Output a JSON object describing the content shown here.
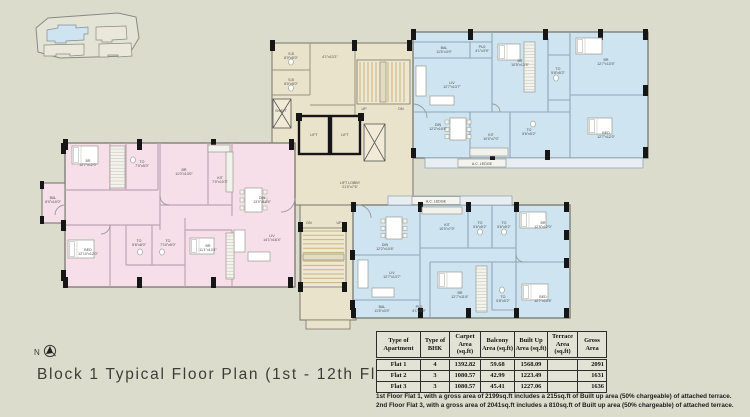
{
  "title": "Block 1 Typical Floor Plan (1st - 12th Floor)",
  "north_label": "N",
  "colors": {
    "background": "#dcdccd",
    "flat1_pink": "#f6dfe9",
    "flat23_blue": "#cee4f0",
    "core_tan": "#eae3cb",
    "stair_tread": "#c9b285",
    "wall_black": "#161616"
  },
  "plan": {
    "ac_ledge_top": "A.C. LEDGE",
    "ac_ledge_bottom": "A.C. LEDGE",
    "labels": [
      {
        "x": 88,
        "y": 162,
        "lines": [
          "BR",
          "12'7\"x12'0\""
        ]
      },
      {
        "x": 142,
        "y": 163,
        "lines": [
          "TO",
          "7'0\"x5'0\""
        ]
      },
      {
        "x": 184,
        "y": 171,
        "lines": [
          "BR",
          "11'0\"x13'0\""
        ]
      },
      {
        "x": 220,
        "y": 179,
        "lines": [
          "KIT",
          "7'0\"x10'3\""
        ]
      },
      {
        "x": 262,
        "y": 199,
        "lines": [
          "DIN",
          "13'0\"x12'4\""
        ]
      },
      {
        "x": 53,
        "y": 199,
        "lines": [
          "BAL",
          "6'0\"x10'0\""
        ]
      },
      {
        "x": 88,
        "y": 251,
        "lines": [
          "BED",
          "12'10\"x12'0\""
        ]
      },
      {
        "x": 139,
        "y": 242,
        "lines": [
          "TO",
          "5'6\"x8'0\""
        ]
      },
      {
        "x": 168,
        "y": 242,
        "lines": [
          "TO",
          "7'10\"x5'0\""
        ]
      },
      {
        "x": 208,
        "y": 247,
        "lines": [
          "BR",
          "11'1\"x10'4\""
        ]
      },
      {
        "x": 272,
        "y": 237,
        "lines": [
          "LIV",
          "14'1\"x16'4\""
        ]
      },
      {
        "x": 291,
        "y": 55,
        "lines": [
          "S.B",
          "8'0\"x5'0\""
        ]
      },
      {
        "x": 291,
        "y": 81,
        "lines": [
          "S.B",
          "8'0\"x5'0\""
        ]
      },
      {
        "x": 281,
        "y": 112,
        "lines": [
          "SHAFT"
        ]
      },
      {
        "x": 330,
        "y": 58,
        "lines": [
          "4'1\"x13'1\""
        ]
      },
      {
        "x": 350,
        "y": 184,
        "lines": [
          "LIFT LOBBY",
          "21'0\"x7'6\""
        ]
      },
      {
        "x": 364,
        "y": 110,
        "lines": [
          "UP"
        ]
      },
      {
        "x": 401,
        "y": 110,
        "lines": [
          "DN"
        ]
      },
      {
        "x": 309,
        "y": 224,
        "lines": [
          "DN"
        ]
      },
      {
        "x": 339,
        "y": 224,
        "lines": [
          "UP"
        ]
      },
      {
        "x": 444,
        "y": 49,
        "lines": [
          "BAL",
          "11'5\"x3'9\""
        ]
      },
      {
        "x": 482,
        "y": 48,
        "lines": [
          "PUJ",
          "4'1\"x3'9\""
        ]
      },
      {
        "x": 452,
        "y": 84,
        "lines": [
          "LIV",
          "12'7\"x13'7\""
        ]
      },
      {
        "x": 438,
        "y": 126,
        "lines": [
          "DIN",
          "12'2\"x10'6\""
        ]
      },
      {
        "x": 491,
        "y": 136,
        "lines": [
          "KIT",
          "10'0\"x7'0\""
        ]
      },
      {
        "x": 520,
        "y": 62,
        "lines": [
          "BR",
          "10'5\"x13'5\""
        ]
      },
      {
        "x": 558,
        "y": 70,
        "lines": [
          "TO",
          "5'8\"x5'2\""
        ]
      },
      {
        "x": 606,
        "y": 61,
        "lines": [
          "BR",
          "12'7\"x13'5\""
        ]
      },
      {
        "x": 529,
        "y": 131,
        "lines": [
          "TO",
          "5'6\"x5'2\""
        ]
      },
      {
        "x": 606,
        "y": 134,
        "lines": [
          "BED",
          "12'7\"x12'0\""
        ]
      },
      {
        "x": 447,
        "y": 226,
        "lines": [
          "KIT",
          "10'0\"x7'0\""
        ]
      },
      {
        "x": 480,
        "y": 224,
        "lines": [
          "TO",
          "5'6\"x5'2\""
        ]
      },
      {
        "x": 504,
        "y": 224,
        "lines": [
          "TO",
          "5'6\"x5'2\""
        ]
      },
      {
        "x": 543,
        "y": 224,
        "lines": [
          "BR",
          "12'9\"x12'0\""
        ]
      },
      {
        "x": 385,
        "y": 246,
        "lines": [
          "DIN",
          "12'2\"x10'6\""
        ]
      },
      {
        "x": 392,
        "y": 274,
        "lines": [
          "LIV",
          "12'7\"x13'7\""
        ]
      },
      {
        "x": 460,
        "y": 294,
        "lines": [
          "BR",
          "12'7\"x11'6\""
        ]
      },
      {
        "x": 503,
        "y": 298,
        "lines": [
          "TO",
          "5'8\"x5'2\""
        ]
      },
      {
        "x": 543,
        "y": 298,
        "lines": [
          "BED",
          "12'7\"x10'6\""
        ]
      },
      {
        "x": 382,
        "y": 308,
        "lines": [
          "BAL",
          "11'5\"x3'9\""
        ]
      },
      {
        "x": 419,
        "y": 308,
        "lines": [
          "PUJ",
          "4'1\"x3'9\""
        ]
      },
      {
        "x": 314,
        "y": 136,
        "lines": [
          "LIFT"
        ]
      },
      {
        "x": 345,
        "y": 136,
        "lines": [
          "LIFT"
        ]
      }
    ]
  },
  "table": {
    "headers": [
      "Type of Apartment",
      "Type of BHK",
      "Carpet Area (sq.ft)",
      "Balcony Area (sq.ft)",
      "Built Up Area (sq.ft)",
      "Terrace Area (sq.ft)",
      "Gross Area"
    ],
    "rows": [
      {
        "apartment": "Flat 1",
        "bhk": "4",
        "carpet": "1392.82",
        "balcony": "59.68",
        "built_up": "1568.09",
        "terrace": "",
        "gross": "2091"
      },
      {
        "apartment": "Flat 2",
        "bhk": "3",
        "carpet": "1080.57",
        "balcony": "42.99",
        "built_up": "1223.49",
        "terrace": "",
        "gross": "1631"
      },
      {
        "apartment": "Flat 3",
        "bhk": "3",
        "carpet": "1080.57",
        "balcony": "45.41",
        "built_up": "1227.06",
        "terrace": "",
        "gross": "1636"
      }
    ]
  },
  "footnotes": [
    "1st Floor Flat 1, with a gross area of 2199sq.ft includes a 215sq.ft of Built up area (50% chargeable) of attached terrace.",
    "2nd Floor Flat 3, with a gross area of 2041sq.ft includes a 810sq.ft of Built up area (50% chargeable) of attached terrace."
  ]
}
